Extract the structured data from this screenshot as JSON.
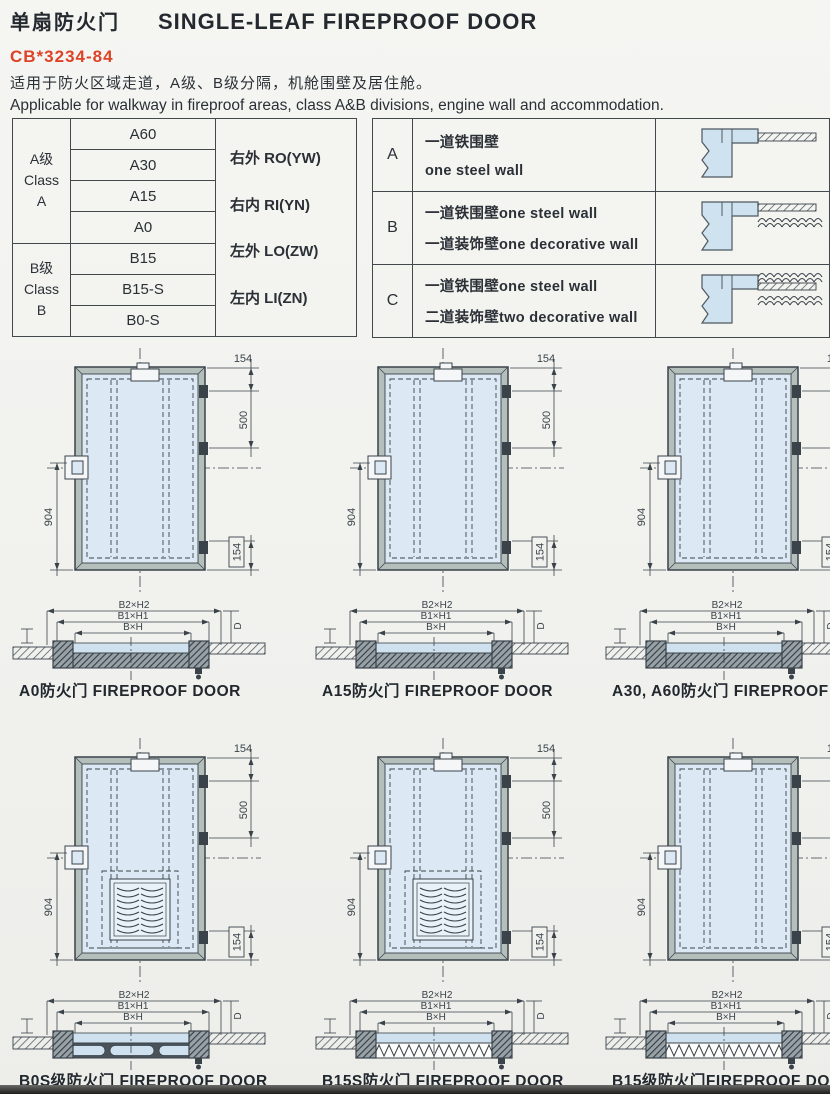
{
  "page": {
    "title_cn": "单扇防火门",
    "title_en": "SINGLE-LEAF FIREPROOF DOOR",
    "standard_code": "CB*3234-84",
    "subtitle_cn": "适用于防火区域走道，A级、B级分隔，机舱围壁及居住舱。",
    "subtitle_en": "Applicable for walkway in fireproof areas, class A&B divisions, engine wall and accommodation."
  },
  "class_table": {
    "groups": [
      {
        "label_lines": [
          "A级",
          "Class",
          "A"
        ],
        "models": [
          "A60",
          "A30",
          "A15",
          "A0"
        ]
      },
      {
        "label_lines": [
          "B级",
          "Class",
          "B"
        ],
        "models": [
          "B15",
          "B15-S",
          "B0-S"
        ]
      }
    ],
    "orientations": [
      "右外 RO(YW)",
      "右内 RI(YN)",
      "左外 LO(ZW)",
      "左内 LI(ZN)"
    ]
  },
  "wall_table": {
    "rows": [
      {
        "key": "A",
        "lines": [
          "一道铁围壁",
          "one steel wall"
        ],
        "diagram": "one-steel-wall"
      },
      {
        "key": "B",
        "lines": [
          "一道铁围壁one steel wall",
          "一道装饰壁one decorative wall"
        ],
        "diagram": "one-steel-wall-one-decorative-wall"
      },
      {
        "key": "C",
        "lines": [
          "一道铁围壁one steel wall",
          "二道装饰壁two decorative wall"
        ],
        "diagram": "one-steel-wall-two-decorative-walls"
      }
    ]
  },
  "drawings": {
    "dimensions": {
      "head_offset": "154",
      "hinge_spacing": "500",
      "handle_height": "904",
      "bottom_offset": "154"
    },
    "section_labels": {
      "outer": "B2×H2",
      "middle": "B1×H1",
      "inner": "B×H",
      "depth": "D"
    },
    "items": [
      {
        "caption": "A0防火门 FIREPROOF DOOR",
        "louver": false,
        "section_style": "hatch"
      },
      {
        "caption": "A15防火门 FIREPROOF DOOR",
        "louver": false,
        "section_style": "hatch"
      },
      {
        "caption": "A30, A60防火门 FIREPROOF DOOR",
        "louver": false,
        "section_style": "hatch"
      },
      {
        "caption": "B0S级防火门 FIREPROOF DOOR",
        "louver": true,
        "section_style": "segments"
      },
      {
        "caption": "B15S防火门 FIREPROOF DOOR",
        "louver": true,
        "section_style": "zigzag"
      },
      {
        "caption": "B15级防火门FIREPROOF DOOR",
        "louver": false,
        "section_style": "zigzag"
      }
    ]
  },
  "colors": {
    "accent_red": "#dd4326",
    "door_fill": "#dce9f4",
    "frame_fill": "#b4beba",
    "line": "#3a434a",
    "page_bg": "#f1f1ee"
  }
}
